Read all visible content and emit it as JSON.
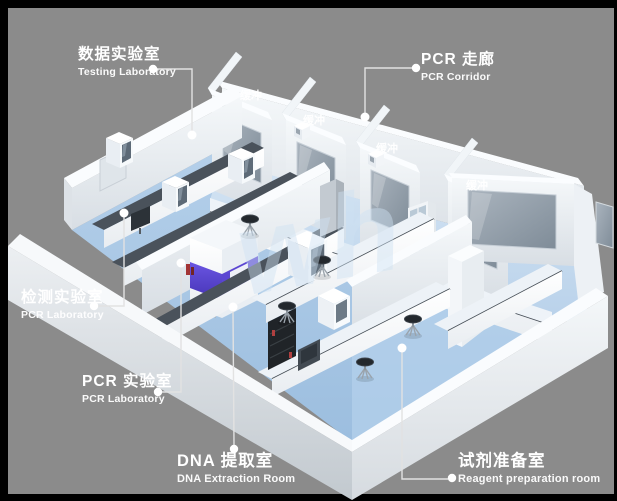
{
  "scene": {
    "description": "3D perspective render of a PCR laboratory suite floor plan",
    "background_color": "#8b8b8b",
    "frame_color": "#000000",
    "watermark_text": "wh",
    "floor_color": "#a9c7e5",
    "corridor_floor_color": "#c6dbee",
    "wall_color": "#eef2f6",
    "counter_color": "#4a525b",
    "accent_purple": "#5643cf",
    "label_color": "#ffffff"
  },
  "callouts": [
    {
      "id": "testing-laboratory",
      "zh": "数据实验室",
      "en": "Testing Laboratory"
    },
    {
      "id": "pcr-corridor",
      "zh": "PCR 走廊",
      "en": "PCR Corridor"
    },
    {
      "id": "detection-laboratory",
      "zh": "检测实验室",
      "en": "PCR Laboratory"
    },
    {
      "id": "pcr-laboratory",
      "zh": "PCR 实验室",
      "en": "PCR Laboratory"
    },
    {
      "id": "dna-extraction-room",
      "zh": "DNA 提取室",
      "en": "DNA Extraction Room"
    },
    {
      "id": "reagent-preparation-room",
      "zh": "试剂准备室",
      "en": "Reagent preparation room"
    }
  ],
  "room_tags": [
    {
      "text": "缓冲"
    },
    {
      "text": "缓冲"
    },
    {
      "text": "缓冲"
    },
    {
      "text": "缓冲"
    }
  ]
}
